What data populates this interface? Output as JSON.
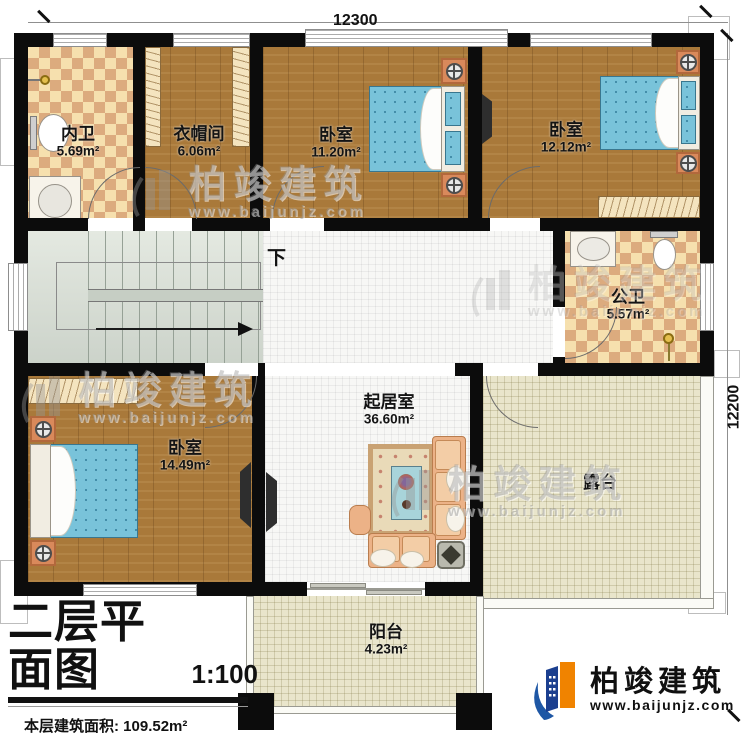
{
  "dimensions": {
    "top": "12300",
    "right": "12200"
  },
  "rooms": [
    {
      "name": "内卫",
      "area": "5.69m²"
    },
    {
      "name": "衣帽间",
      "area": "6.06m²"
    },
    {
      "name": "卧室",
      "area": "11.20m²"
    },
    {
      "name": "卧室",
      "area": "12.12m²"
    },
    {
      "name": "公卫",
      "area": "5.57m²"
    },
    {
      "name": "卧室",
      "area": "14.49m²"
    },
    {
      "name": "起居室",
      "area": "36.60m²"
    },
    {
      "name": "露台",
      "area": ""
    },
    {
      "name": "阳台",
      "area": "4.23m²"
    }
  ],
  "stairs": {
    "down_label": "下"
  },
  "title_block": {
    "title": "二层平面图",
    "scale": "1:100",
    "floor_area": "本层建筑面积: 109.52m²",
    "floor_height": "层高: 3.6m"
  },
  "branding": {
    "company": "柏竣建筑",
    "website": "www.baijunjz.com"
  },
  "watermark": {
    "company": "柏竣建筑",
    "website": "www.baijunjz.com"
  },
  "colors": {
    "wall": "#0c0c0c",
    "wood": "#a9793a",
    "checker_light": "#f6e0ae",
    "checker_dark": "#dcab7e",
    "bed_blue": "#79c3da",
    "logo_blue": "#1e57a5",
    "logo_orange": "#f08300"
  }
}
